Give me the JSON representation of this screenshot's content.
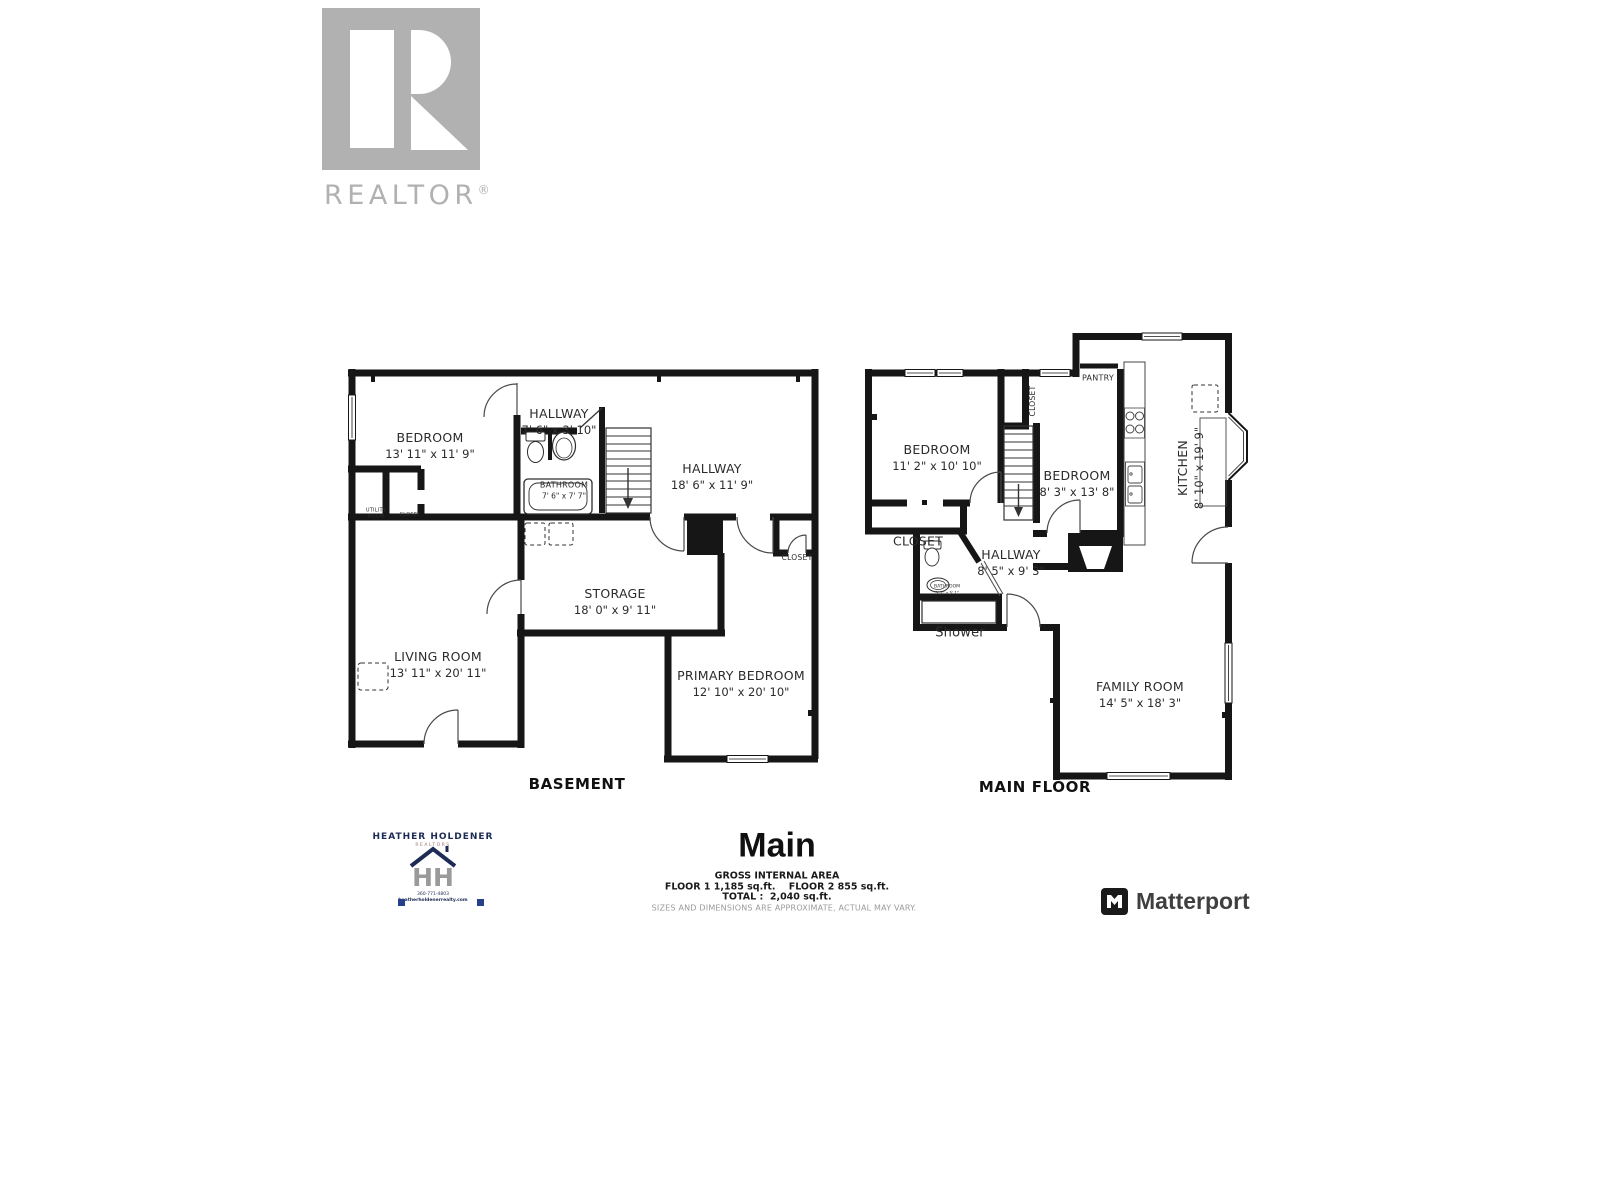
{
  "realtor_logo": {
    "text": "REALTOR",
    "reg": "®"
  },
  "basement": {
    "floor_label": "BASEMENT",
    "rooms": {
      "bedroom": {
        "name": "BEDROOM",
        "dims": "13' 11\" x 11' 9\""
      },
      "hallway_upper": {
        "name": "HALLWAY",
        "dims": "7' 6\" x 3' 10\""
      },
      "bathroom": {
        "name": "BATHROOM",
        "dims": "7' 6\" x 7' 7\""
      },
      "hallway": {
        "name": "HALLWAY",
        "dims": "18' 6\" x 11' 9\""
      },
      "utility_room": {
        "line1": "UTILITY",
        "line2": "ROOM"
      },
      "closet_small": {
        "name": "CLOSET"
      },
      "closet_right": {
        "name": "CLOSET"
      },
      "storage": {
        "name": "STORAGE",
        "dims": "18' 0\" x 9' 11\""
      },
      "living_room": {
        "name": "LIVING ROOM",
        "dims": "13' 11\" x 20' 11\""
      },
      "primary_bedroom": {
        "name": "PRIMARY BEDROOM",
        "dims": "12' 10\" x 20' 10\""
      }
    }
  },
  "main_floor": {
    "floor_label": "MAIN FLOOR",
    "rooms": {
      "bedroom_left": {
        "name": "BEDROOM",
        "dims": "11' 2\" x 10' 10\""
      },
      "closet_top": {
        "name": "CLOSET"
      },
      "pantry": {
        "name": "PANTRY"
      },
      "bedroom_right": {
        "name": "BEDROOM",
        "dims": "8' 3\" x 13' 8\""
      },
      "kitchen": {
        "name": "KITCHEN",
        "dims": "8' 10\" x 19' 9\""
      },
      "closet_left": {
        "name": "CLOSET"
      },
      "hallway": {
        "name": "HALLWAY",
        "dims": "8' 5\" x 9' 3\""
      },
      "bathroom": {
        "name": "BATHROOM",
        "dims": "5' 2\" x 5' 1\""
      },
      "shower": {
        "name": "Shower"
      },
      "family_room": {
        "name": "FAMILY ROOM",
        "dims": "14' 5\" x 18' 3\""
      }
    }
  },
  "footer": {
    "title": "Main",
    "area_heading": "GROSS INTERNAL AREA",
    "area_line1": "FLOOR 1 1,185 sq.ft.    FLOOR 2 855 sq.ft.",
    "area_line2": "TOTAL :  2,040 sq.ft.",
    "disclaimer": "SIZES AND DIMENSIONS ARE APPROXIMATE, ACTUAL MAY VARY."
  },
  "branding": {
    "agent": {
      "name": "HEATHER HOLDENER",
      "subtitle": "REALTORS",
      "phone": "360-771-4803",
      "website": "heatherholdenerrealty.com"
    },
    "matterport": "Matterport"
  },
  "colors": {
    "wall": "#161616",
    "text": "#2b2b2b",
    "logo_gray": "#b1b1b1",
    "navy": "#1d2b55"
  }
}
